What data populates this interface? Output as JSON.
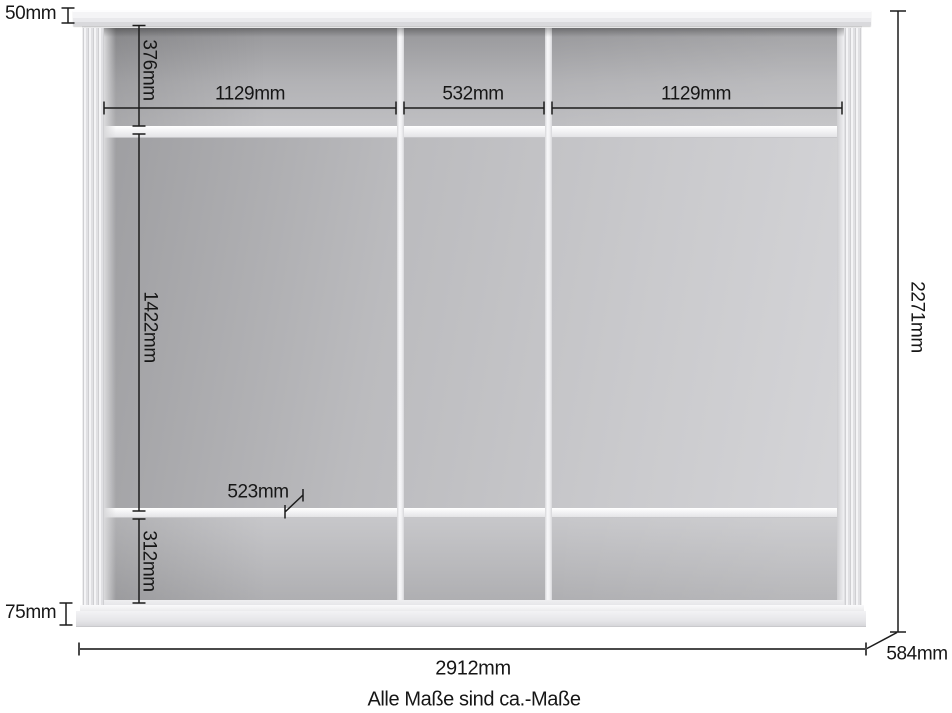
{
  "note": "Alle Maße sind ca.-Maße",
  "dims": {
    "crown_height": "50mm",
    "top_compartment_height": "376mm",
    "left_compartment_width": "1129mm",
    "middle_compartment_width": "532mm",
    "right_compartment_width": "1129mm",
    "main_compartment_height": "1422mm",
    "shelf_depth": "523mm",
    "bottom_compartment_height": "312mm",
    "plinth_height": "75mm",
    "total_height": "2271mm",
    "total_width": "2912mm",
    "total_depth": "584mm"
  },
  "colors": {
    "dimension_line": "#1c1c1c",
    "total_width_line": "#4a4a4a",
    "cabinet_body": "#eeeeef",
    "interior_dark": "#97979a",
    "interior_light": "#d5d5d8"
  }
}
